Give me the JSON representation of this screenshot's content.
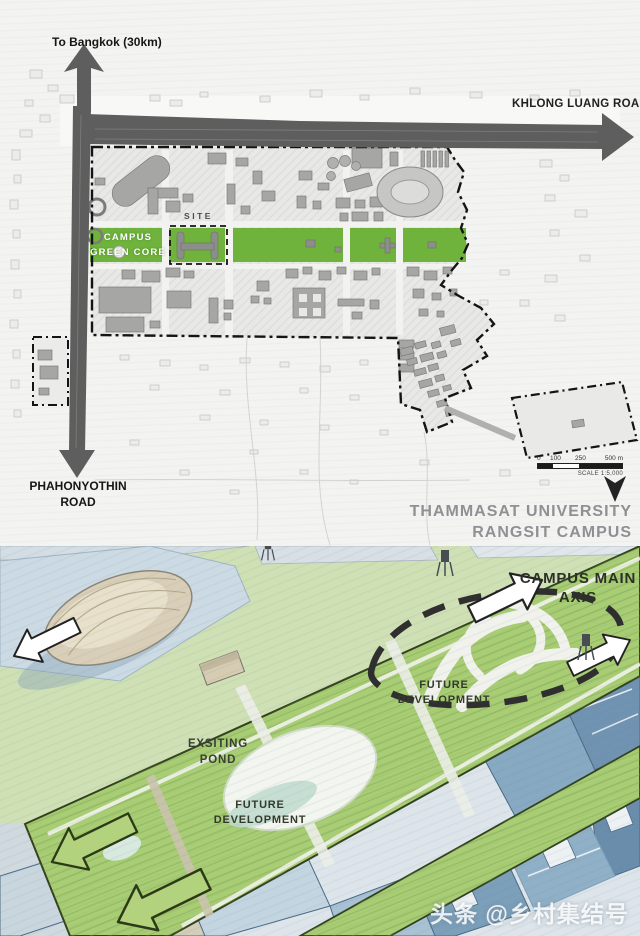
{
  "site_plan": {
    "road_labels": {
      "to_bangkok": "To Bangkok (30km)",
      "khlong_luang": "KHLONG LUANG ROAD",
      "phahonyothin_line1": "PHAHONYOTHIN",
      "phahonyothin_line2": "ROAD"
    },
    "area_labels": {
      "site": "SITE",
      "green_core_line1": "CAMPUS",
      "green_core_line2": "GREEN CORE"
    },
    "title": {
      "line1": "THAMMASAT UNIVERSITY",
      "line2": "RANGSIT CAMPUS"
    },
    "scale_bar": {
      "tick_0": "0",
      "tick_100": "100",
      "tick_250": "250",
      "tick_500": "500 m",
      "caption": "SCALE 1:5,000"
    },
    "colors": {
      "green_core": "#6fb33c",
      "road": "#5e5e5e",
      "campus_fill": "#e8e8e6",
      "boundary": "#141414"
    }
  },
  "perspective": {
    "labels": {
      "main_axis_line1": "CAMPUS MAIN",
      "main_axis_line2": "AXIS",
      "future_development_line1": "FUTURE",
      "future_development_line2": "DEVELOPMENT",
      "pond_line1": "EXSITING",
      "pond_line2": "POND"
    },
    "colors": {
      "axis_green": "#a9cd74",
      "lawn_green": "#cfe0b4",
      "building_blue": "#7c9fba",
      "sky_paper": "#eef0ec"
    }
  },
  "watermark": {
    "text": "头条 @乡村集结号"
  }
}
